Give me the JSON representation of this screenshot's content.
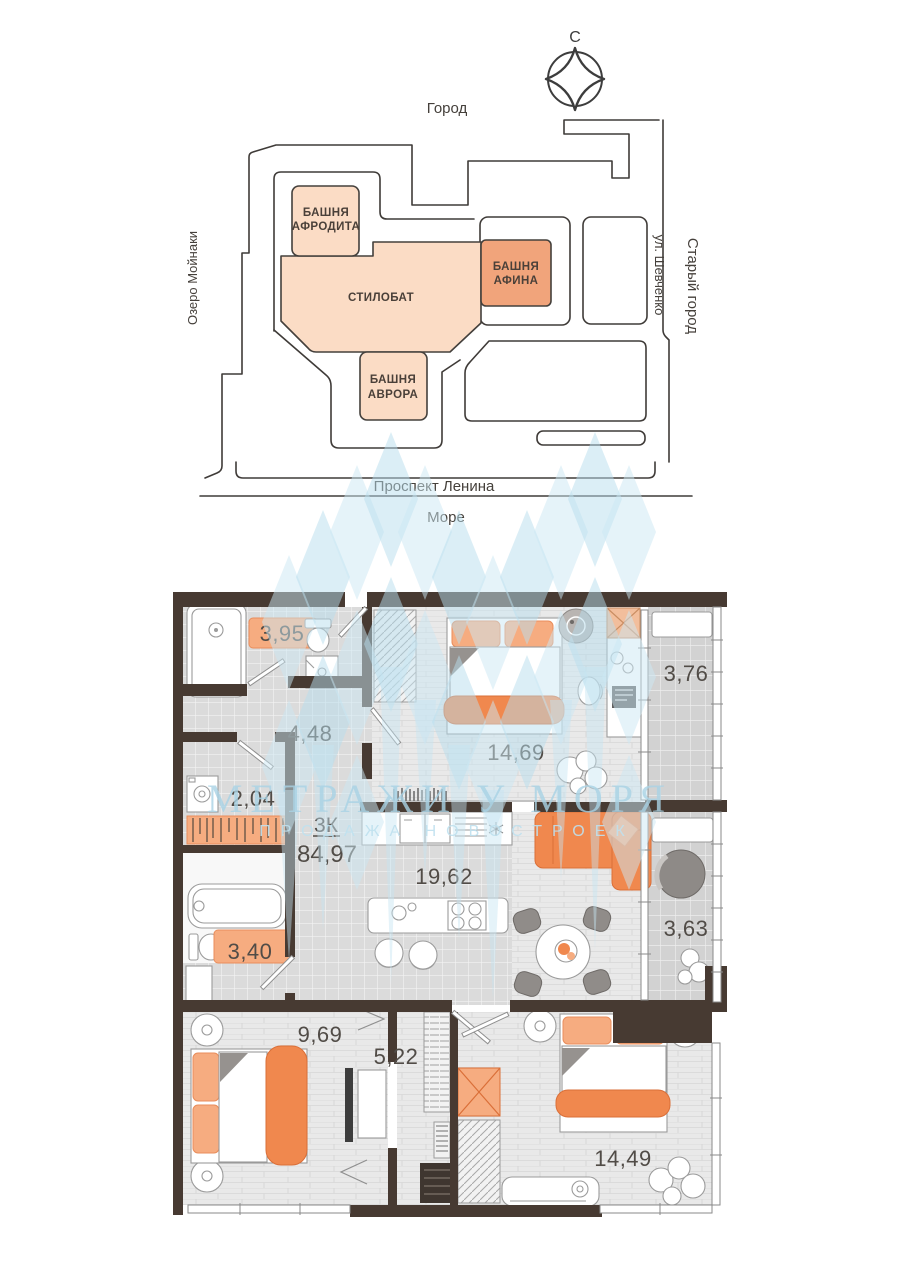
{
  "site_plan": {
    "north_label": "С",
    "city": "Город",
    "lake": "Озеро Мойнаки",
    "shevchenko_street": "ул. Шевченко",
    "old_town": "Старый город",
    "lenin_avenue": "Проспект Ленина",
    "sea": "Море",
    "buildings": {
      "aphrodite_line1": "БАШНЯ",
      "aphrodite_line2": "АФРОДИТА",
      "stylobate": "СТИЛОБАТ",
      "athena_line1": "БАШНЯ",
      "athena_line2": "АФИНА",
      "aurora_line1": "БАШНЯ",
      "aurora_line2": "АВРОРА"
    }
  },
  "floor_plan": {
    "apartment_type": "3К",
    "total_area": "84,97",
    "rooms": {
      "bathroom_top": "3,95",
      "hallway": "4,48",
      "bedroom_top": "14,69",
      "balcony_top": "3,76",
      "storage": "2,04",
      "kitchen_living": "19,62",
      "balcony_bottom": "3,63",
      "bathroom_bottom": "3,40",
      "bedroom_left": "9,69",
      "corridor": "5,22",
      "bedroom_right": "14,49"
    }
  },
  "watermark": {
    "title": "МЕТРАЖИ У МОРЯ",
    "subtitle": "ПРОДАЖА НОВОСТРОЕК"
  },
  "colors": {
    "peach_light": "#FBDCC5",
    "peach_dark": "#F1A47B",
    "orange": "#F0884E",
    "orange_light": "#F6AC80",
    "wall": "#473A32",
    "watermark_blue": "#C9E6F2"
  }
}
